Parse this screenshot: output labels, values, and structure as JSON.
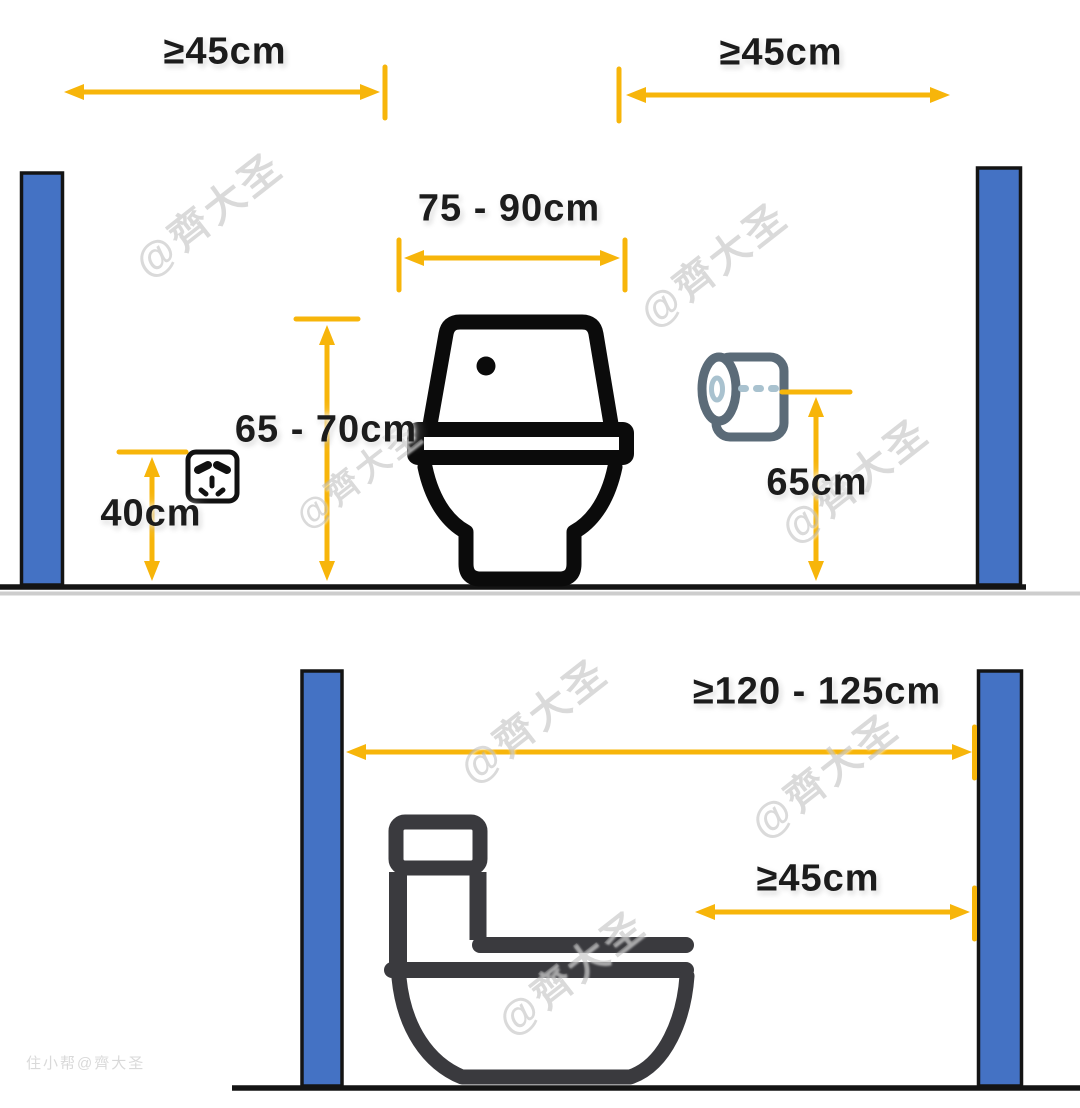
{
  "panels": {
    "front_view": {
      "left_clearance_label": "≥45cm",
      "right_clearance_label": "≥45cm",
      "toilet_zone_width_label": "75 - 90cm",
      "tank_height_label": "65 - 70cm",
      "socket_height_label": "40cm",
      "paper_holder_height_label": "65cm"
    },
    "side_view": {
      "front_clearance_label": "≥120 - 125cm",
      "min_front_clearance_label": "≥45cm"
    }
  },
  "watermark": {
    "text": "@齊大圣",
    "corner_text": "住小帮@齊大圣"
  },
  "colors": {
    "dimension_accent": "#F7B50A",
    "wall_fill": "#4472C4",
    "wall_border": "#141414",
    "toilet_front": "#0B0B0B",
    "toilet_side": "#3A3A3E",
    "floor_line": "#141414",
    "separator_line": "#CDCDCD",
    "paper_outline": "#5B6B78",
    "paper_detail": "#A9C2CF"
  },
  "icons": {
    "socket": "power-socket-icon",
    "paper": "toilet-paper-icon"
  }
}
